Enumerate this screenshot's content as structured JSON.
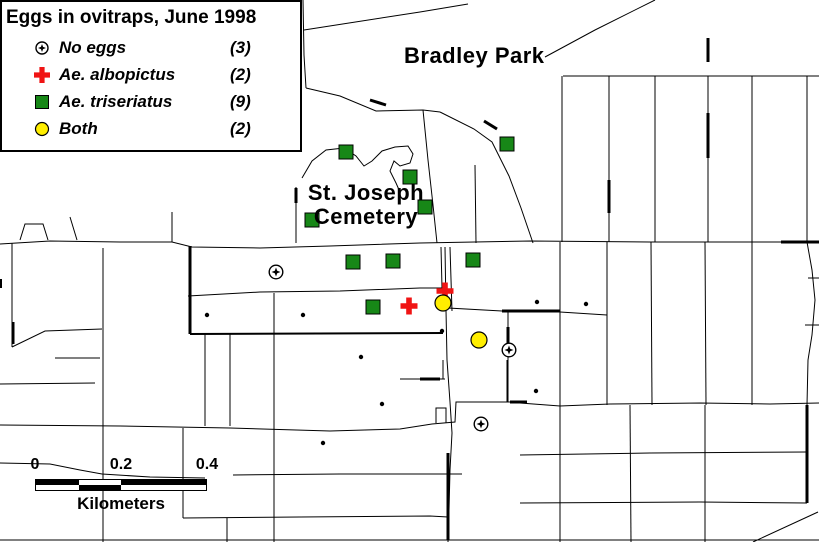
{
  "legend": {
    "title": "Eggs in ovitraps, June 1998",
    "items": [
      {
        "symbol": "no-eggs",
        "label": "No eggs",
        "count": "(3)"
      },
      {
        "symbol": "albopictus",
        "label": "Ae. albopictus",
        "count": "(2)"
      },
      {
        "symbol": "triseriatus",
        "label": "Ae. triseriatus",
        "count": "(9)"
      },
      {
        "symbol": "both",
        "label": "Both",
        "count": "(2)"
      }
    ]
  },
  "map_labels": {
    "park": "Bradley Park",
    "cemetery_line1": "St. Joseph",
    "cemetery_line2": "Cemetery"
  },
  "scale_bar": {
    "tick0": "0",
    "tick1": "0.2",
    "tick2": "0.4",
    "unit": "Kilometers"
  },
  "colors": {
    "triseriatus_green": "#178717",
    "albopictus_red": "#F01414",
    "both_yellow": "#FFEE00",
    "line_black": "#000000",
    "background_white": "#FFFFFF"
  },
  "map": {
    "markers": {
      "triseriatus": [
        [
          346,
          152
        ],
        [
          507,
          144
        ],
        [
          410,
          177
        ],
        [
          425,
          207
        ],
        [
          312,
          220
        ],
        [
          353,
          262
        ],
        [
          393,
          261
        ],
        [
          473,
          260
        ],
        [
          373,
          307
        ]
      ],
      "albopictus": [
        [
          445,
          291
        ],
        [
          409,
          306
        ]
      ],
      "both": [
        [
          443,
          303
        ],
        [
          479,
          340
        ]
      ],
      "no_eggs": [
        [
          276,
          272
        ],
        [
          509,
          350
        ],
        [
          481,
          424
        ]
      ],
      "unlabeled_dots": [
        [
          207,
          315
        ],
        [
          303,
          315
        ],
        [
          361,
          357
        ],
        [
          442,
          331
        ],
        [
          537,
          302
        ],
        [
          586,
          304
        ],
        [
          536,
          391
        ],
        [
          382,
          404
        ],
        [
          323,
          443
        ]
      ]
    },
    "roads": [
      {
        "pts": [
          [
            0,
            244
          ],
          [
            50,
            241
          ],
          [
            120,
            242
          ],
          [
            172,
            242
          ],
          [
            192,
            247
          ],
          [
            260,
            248
          ],
          [
            330,
            246
          ],
          [
            420,
            243
          ],
          [
            530,
            241
          ],
          [
            650,
            242
          ],
          [
            819,
            242
          ]
        ]
      },
      {
        "pts": [
          [
            303,
            0
          ],
          [
            304,
            55
          ],
          [
            306,
            88
          ]
        ]
      },
      {
        "pts": [
          [
            304,
            30
          ],
          [
            420,
            12
          ],
          [
            468,
            4
          ]
        ]
      },
      {
        "pts": [
          [
            306,
            88
          ],
          [
            340,
            96
          ],
          [
            376,
            111
          ],
          [
            423,
            110
          ],
          [
            440,
            112
          ]
        ]
      },
      {
        "pts": [
          [
            440,
            112
          ],
          [
            474,
            129
          ],
          [
            492,
            142
          ],
          [
            509,
            176
          ],
          [
            521,
            208
          ],
          [
            533,
            243
          ]
        ]
      },
      {
        "pts": [
          [
            423,
            110
          ],
          [
            428,
            160
          ],
          [
            433,
            205
          ],
          [
            437,
            243
          ]
        ]
      },
      {
        "pts": [
          [
            655,
            0
          ],
          [
            595,
            30
          ],
          [
            545,
            57
          ]
        ]
      },
      {
        "pts": [
          [
            563,
            76
          ],
          [
            819,
            76
          ]
        ]
      },
      {
        "pts": [
          [
            562,
            76
          ],
          [
            562,
            242
          ]
        ]
      },
      {
        "pts": [
          [
            609,
            76
          ],
          [
            609,
            242
          ]
        ]
      },
      {
        "pts": [
          [
            655,
            76
          ],
          [
            655,
            242
          ]
        ]
      },
      {
        "pts": [
          [
            708,
            76
          ],
          [
            708,
            242
          ]
        ]
      },
      {
        "pts": [
          [
            752,
            76
          ],
          [
            752,
            242
          ]
        ]
      },
      {
        "pts": [
          [
            807,
            76
          ],
          [
            807,
            242
          ]
        ]
      },
      {
        "pts": [
          [
            12,
            243
          ],
          [
            12,
            347
          ]
        ]
      },
      {
        "pts": [
          [
            12,
            347
          ],
          [
            45,
            331
          ],
          [
            102,
            329
          ]
        ]
      },
      {
        "pts": [
          [
            55,
            358
          ],
          [
            100,
            358
          ]
        ]
      },
      {
        "pts": [
          [
            0,
            384
          ],
          [
            95,
            383
          ]
        ]
      },
      {
        "pts": [
          [
            103,
            248
          ],
          [
            103,
            542
          ]
        ]
      },
      {
        "pts": [
          [
            172,
            212
          ],
          [
            172,
            242
          ]
        ]
      },
      {
        "pts": [
          [
            296,
            187
          ],
          [
            296,
            243
          ]
        ]
      },
      {
        "pts": [
          [
            20,
            240
          ],
          [
            25,
            224
          ],
          [
            43,
            224
          ],
          [
            48,
            240
          ]
        ]
      },
      {
        "pts": [
          [
            70,
            217
          ],
          [
            77,
            240
          ]
        ]
      },
      {
        "pts": [
          [
            190,
            246
          ],
          [
            190,
            334
          ]
        ],
        "w": 3
      },
      {
        "pts": [
          [
            190,
            334
          ],
          [
            443,
            333
          ]
        ],
        "w": 2
      },
      {
        "pts": [
          [
            205,
            334
          ],
          [
            205,
            426
          ]
        ]
      },
      {
        "pts": [
          [
            230,
            334
          ],
          [
            230,
            426
          ]
        ]
      },
      {
        "pts": [
          [
            274,
            293
          ],
          [
            274,
            542
          ]
        ]
      },
      {
        "pts": [
          [
            188,
            296
          ],
          [
            260,
            292
          ],
          [
            340,
            291
          ],
          [
            420,
            288
          ],
          [
            443,
            288
          ]
        ]
      },
      {
        "pts": [
          [
            443,
            288
          ],
          [
            448,
            308
          ],
          [
            502,
            311
          ],
          [
            560,
            312
          ],
          [
            607,
            315
          ]
        ]
      },
      {
        "pts": [
          [
            441,
            247
          ],
          [
            442,
            288
          ]
        ]
      },
      {
        "pts": [
          [
            450,
            247
          ],
          [
            452,
            311
          ]
        ]
      },
      {
        "pts": [
          [
            445,
            247
          ],
          [
            446,
            310
          ],
          [
            447,
            360
          ],
          [
            450,
            402
          ],
          [
            452,
            433
          ],
          [
            450,
            470
          ],
          [
            449,
            510
          ],
          [
            448,
            542
          ]
        ]
      },
      {
        "pts": [
          [
            502,
            311
          ],
          [
            560,
            311
          ]
        ],
        "w": 3
      },
      {
        "pts": [
          [
            508,
            312
          ],
          [
            508,
            402
          ]
        ]
      },
      {
        "pts": [
          [
            508,
            327
          ],
          [
            508,
            344
          ]
        ],
        "w": 3
      },
      {
        "pts": [
          [
            0,
            425
          ],
          [
            120,
            426
          ],
          [
            230,
            428
          ],
          [
            330,
            431
          ],
          [
            400,
            429
          ],
          [
            432,
            424
          ],
          [
            455,
            422
          ],
          [
            456,
            402
          ],
          [
            510,
            402
          ]
        ]
      },
      {
        "pts": [
          [
            510,
            402
          ],
          [
            527,
            402
          ]
        ],
        "w": 3
      },
      {
        "pts": [
          [
            507,
            360
          ],
          [
            507,
            402
          ]
        ]
      },
      {
        "pts": [
          [
            520,
            403
          ],
          [
            560,
            406
          ],
          [
            610,
            404
          ],
          [
            700,
            403
          ],
          [
            770,
            404
          ],
          [
            819,
            403
          ]
        ]
      },
      {
        "pts": [
          [
            560,
            242
          ],
          [
            560,
            542
          ]
        ]
      },
      {
        "pts": [
          [
            607,
            242
          ],
          [
            607,
            405
          ]
        ]
      },
      {
        "pts": [
          [
            651,
            242
          ],
          [
            652,
            405
          ]
        ]
      },
      {
        "pts": [
          [
            705,
            242
          ],
          [
            706,
            405
          ]
        ]
      },
      {
        "pts": [
          [
            752,
            242
          ],
          [
            752,
            405
          ]
        ]
      },
      {
        "pts": [
          [
            807,
            242
          ],
          [
            812,
            270
          ],
          [
            815,
            300
          ],
          [
            812,
            335
          ],
          [
            808,
            360
          ],
          [
            807,
            405
          ]
        ]
      },
      {
        "pts": [
          [
            630,
            405
          ],
          [
            631,
            542
          ]
        ]
      },
      {
        "pts": [
          [
            705,
            405
          ],
          [
            705,
            542
          ]
        ]
      },
      {
        "pts": [
          [
            520,
            455
          ],
          [
            650,
            453
          ],
          [
            807,
            452
          ]
        ]
      },
      {
        "pts": [
          [
            520,
            503
          ],
          [
            700,
            502
          ],
          [
            807,
            503
          ]
        ]
      },
      {
        "pts": [
          [
            807,
            405
          ],
          [
            807,
            503
          ]
        ],
        "w": 3
      },
      {
        "pts": [
          [
            753,
            542
          ],
          [
            818,
            512
          ]
        ]
      },
      {
        "pts": [
          [
            233,
            475
          ],
          [
            340,
            474
          ],
          [
            462,
            474
          ]
        ]
      },
      {
        "pts": [
          [
            183,
            518
          ],
          [
            300,
            517
          ],
          [
            430,
            516
          ],
          [
            448,
            517
          ]
        ]
      },
      {
        "pts": [
          [
            183,
            428
          ],
          [
            183,
            518
          ]
        ]
      },
      {
        "pts": [
          [
            227,
            518
          ],
          [
            227,
            542
          ]
        ]
      },
      {
        "pts": [
          [
            0,
            463
          ],
          [
            50,
            464
          ],
          [
            80,
            470
          ],
          [
            102,
            474
          ],
          [
            150,
            477
          ],
          [
            205,
            478
          ]
        ]
      },
      {
        "pts": [
          [
            0,
            540
          ],
          [
            819,
            540
          ]
        ]
      },
      {
        "pts": [
          [
            436,
            423
          ],
          [
            436,
            408
          ],
          [
            446,
            408
          ],
          [
            446,
            423
          ]
        ]
      },
      {
        "pts": [
          [
            400,
            379
          ],
          [
            445,
            379
          ]
        ]
      },
      {
        "pts": [
          [
            420,
            379
          ],
          [
            440,
            379
          ]
        ],
        "w": 3
      },
      {
        "pts": [
          [
            443,
            360
          ],
          [
            443,
            379
          ]
        ]
      },
      {
        "pts": [
          [
            370,
            100
          ],
          [
            386,
            105
          ]
        ],
        "w": 3
      },
      {
        "pts": [
          [
            484,
            121
          ],
          [
            497,
            129
          ]
        ],
        "w": 3
      },
      {
        "pts": [
          [
            781,
            242
          ],
          [
            819,
            242
          ]
        ],
        "w": 3
      },
      {
        "pts": [
          [
            296,
            188
          ],
          [
            296,
            203
          ]
        ],
        "w": 3
      },
      {
        "pts": [
          [
            13,
            322
          ],
          [
            13,
            344
          ]
        ],
        "w": 3
      },
      {
        "pts": [
          [
            0,
            279
          ],
          [
            0,
            288
          ]
        ],
        "w": 4
      },
      {
        "pts": [
          [
            708,
            113
          ],
          [
            708,
            158
          ]
        ],
        "w": 3
      },
      {
        "pts": [
          [
            708,
            38
          ],
          [
            708,
            62
          ]
        ],
        "w": 3
      },
      {
        "pts": [
          [
            609,
            180
          ],
          [
            609,
            213
          ]
        ],
        "w": 3
      },
      {
        "pts": [
          [
            448,
            453
          ],
          [
            448,
            540
          ]
        ],
        "w": 3
      },
      {
        "pts": [
          [
            808,
            278
          ],
          [
            819,
            278
          ]
        ]
      },
      {
        "pts": [
          [
            805,
            325
          ],
          [
            819,
            325
          ]
        ]
      },
      {
        "pts": [
          [
            475,
            165
          ],
          [
            476,
            243
          ]
        ]
      },
      {
        "pts": [
          [
            302,
            178
          ],
          [
            312,
            161
          ],
          [
            326,
            150
          ],
          [
            344,
            148
          ],
          [
            356,
            156
          ],
          [
            364,
            166
          ],
          [
            372,
            161
          ],
          [
            382,
            151
          ],
          [
            395,
            147
          ],
          [
            408,
            146
          ],
          [
            413,
            154
          ],
          [
            410,
            163
          ],
          [
            400,
            166
          ],
          [
            394,
            161
          ],
          [
            390,
            171
          ],
          [
            396,
            183
          ],
          [
            400,
            192
          ]
        ]
      }
    ]
  }
}
